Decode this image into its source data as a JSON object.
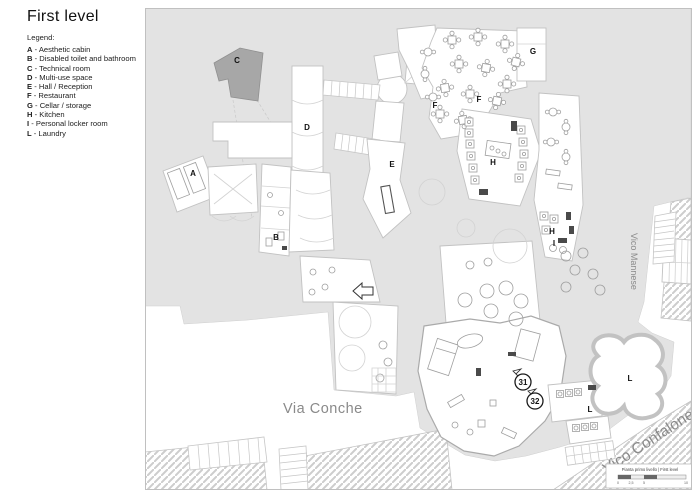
{
  "title": "First level",
  "legend": {
    "heading": "Legend:",
    "separator": "-",
    "items": [
      {
        "key": "A",
        "label": "Aesthetic cabin"
      },
      {
        "key": "B",
        "label": "Disabled toilet and bathroom"
      },
      {
        "key": "C",
        "label": "Technical room"
      },
      {
        "key": "D",
        "label": "Multi-use space"
      },
      {
        "key": "E",
        "label": "Hall / Reception"
      },
      {
        "key": "F",
        "label": "Restaurant"
      },
      {
        "key": "G",
        "label": "Cellar / storage"
      },
      {
        "key": "H",
        "label": "Kitchen"
      },
      {
        "key": "I",
        "label": "Personal locker room"
      },
      {
        "key": "L",
        "label": "Laundry"
      }
    ]
  },
  "map": {
    "room_labels": {
      "A": "A",
      "B": "B",
      "C": "C",
      "D": "D",
      "E": "E",
      "F": "F",
      "G": "G",
      "H": "H",
      "I": "I",
      "L": "L"
    },
    "streets": {
      "via_conche": "Via Conche",
      "vico_mannese": "Vico Mannese",
      "vico_confalone": "Vico Confalone"
    },
    "entrances": {
      "n31": "31",
      "n32": "32"
    },
    "titleblock": {
      "caption": "Pianta primo livello | First level",
      "scale_ticks": [
        "0",
        "2,5",
        "5",
        "10"
      ]
    }
  },
  "colors": {
    "block_gray": "#e3e3e3",
    "technical_room_gray": "#a7a7a7",
    "street_text_gray": "#8a8a8a"
  }
}
